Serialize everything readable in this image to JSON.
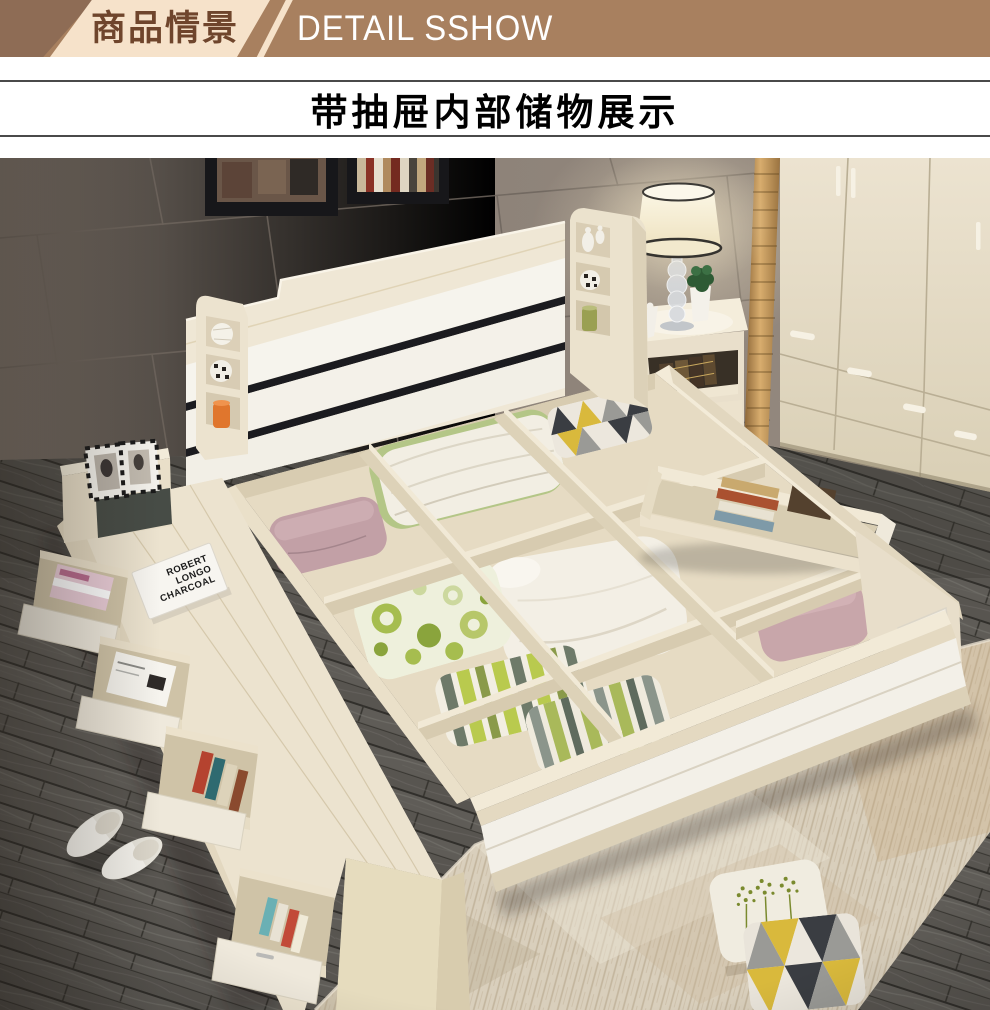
{
  "banner": {
    "label_cn": "商品情景",
    "label_en": "DETAIL SSHOW",
    "colors": {
      "bg": "#a8805f",
      "dark_wedge": "#8e6c55",
      "cream_wedge": "#f6e2ca",
      "text_cn": "#6f452c",
      "text_en": "#ffffff"
    }
  },
  "section": {
    "title": "带抽屉内部储物展示",
    "rule_color": "#4a4a4a"
  },
  "photo": {
    "scene": "bedroom render: storage bed with lid removed showing wooden compartments filled with bedding, side bench with pulled-out book drawers, nightstand with glass table lamp, cream wardrobe, gray tiled wall, dark wood plank floor, beige rug, white slippers, two throw pillows",
    "book": {
      "line1": "ROBERT",
      "line2": "LONGO",
      "line3": "CHARCOAL"
    },
    "palette": {
      "wall": "#8b8077",
      "wall_grout": "#6e655d",
      "floor": "#5e5b56",
      "floor_seam": "#312f2b",
      "wood_cream": "#ece3cf",
      "wood_light": "#f4ecd9",
      "wood_shade": "#d7cbb0",
      "upholstery_white": "#f4f1ea",
      "slat_gap": "#1b1b1f",
      "gold_trim": "#c89a5a",
      "rug": "#d9cfbc",
      "pillow_mauve": "#c2a0a6",
      "pillow_pink": "#c8a6aa",
      "duvet_green": "#b4c687",
      "circle_green": "#a6bd4f",
      "stripe_green": "#b9ca4e",
      "stripe_gray": "#6e7a69",
      "triangle_yellow": "#d9b93c",
      "triangle_black": "#3a3d42",
      "triangle_gray": "#9a9a96",
      "jar_orange": "#e0762d",
      "lamp_shade": "#f7f0d6",
      "plant_green": "#2e5a34",
      "niche_dark": "#383026"
    },
    "objects": [
      "wall-tiles",
      "picture-frames",
      "gold-mosaic-trim",
      "wardrobe",
      "nightstand",
      "table-lamp",
      "potted-plant",
      "bird-figurine",
      "headboard",
      "headboard-shelf-left",
      "headboard-shelf-right",
      "storage-compartments",
      "side-drawer-with-books",
      "mauve-pillow",
      "white-duvet-green-trim",
      "geometric-pillow",
      "big-white-pillow",
      "pink-pillow",
      "circle-pattern-pillow",
      "striped-pillows",
      "bench",
      "bench-photo-frames",
      "bench-book",
      "bench-drawers",
      "wood-floor",
      "rug",
      "slippers",
      "dandelion-throw-pillow",
      "triangle-throw-pillow"
    ]
  }
}
